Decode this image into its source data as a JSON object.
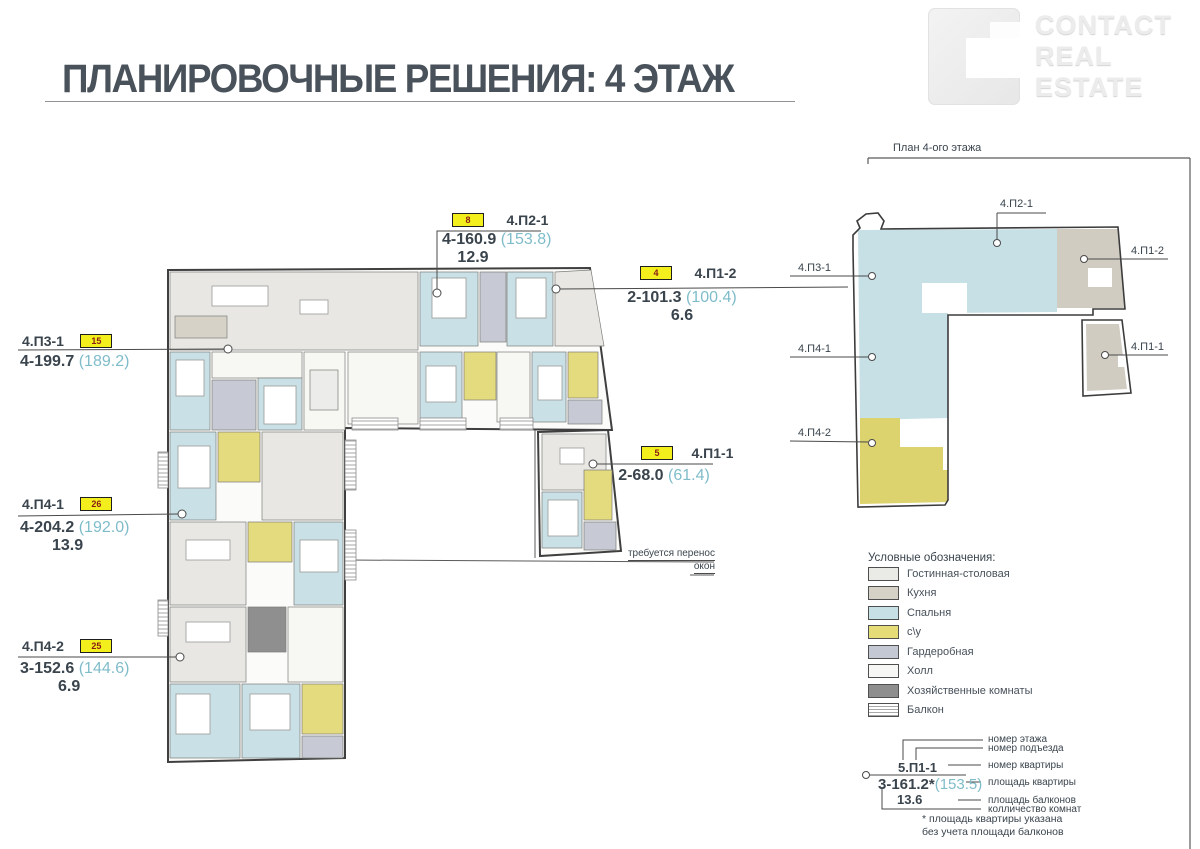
{
  "header": {
    "title": "ПЛАНИРОВОЧНЫЕ РЕШЕНИЯ: 4 ЭТАЖ"
  },
  "logo": {
    "line1": "CONTACT",
    "line2": "REAL",
    "line3": "ESTATE"
  },
  "key_plan": {
    "title": "План 4-ого этажа",
    "labels": [
      "4.П2-1",
      "4.П1-2",
      "4.П3-1",
      "4.П4-1",
      "4.П1-1",
      "4.П4-2"
    ]
  },
  "apartments": [
    {
      "id": "4.П2-1",
      "flat_number": "8",
      "rooms_area": "4-160.9",
      "net_area": "(153.8)",
      "balcony_area": "12.9"
    },
    {
      "id": "4.П1-2",
      "flat_number": "4",
      "rooms_area": "2-101.3",
      "net_area": "(100.4)",
      "balcony_area": "6.6"
    },
    {
      "id": "4.П3-1",
      "flat_number": "15",
      "rooms_area": "4-199.7",
      "net_area": "(189.2)",
      "balcony_area": ""
    },
    {
      "id": "4.П4-1",
      "flat_number": "26",
      "rooms_area": "4-204.2",
      "net_area": "(192.0)",
      "balcony_area": "13.9"
    },
    {
      "id": "4.П4-2",
      "flat_number": "25",
      "rooms_area": "3-152.6",
      "net_area": "(144.6)",
      "balcony_area": "6.9"
    },
    {
      "id": "4.П1-1",
      "flat_number": "5",
      "rooms_area": "2-68.0",
      "net_area": "(61.4)",
      "balcony_area": ""
    }
  ],
  "note": {
    "line1": "требуется перенос",
    "line2": "окон"
  },
  "legend": {
    "title": "Условные обозначения:",
    "items": [
      {
        "label": "Гостинная-столовая",
        "color": "#eaeae7"
      },
      {
        "label": "Кухня",
        "color": "#d5d1c7"
      },
      {
        "label": "Спальня",
        "color": "#c7e0e5"
      },
      {
        "label": "с\\у",
        "color": "#e5dc78"
      },
      {
        "label": "Гардеробная",
        "color": "#c4c8d3"
      },
      {
        "label": "Холл",
        "color": "#f7f7f6"
      },
      {
        "label": "Хозяйственные комнаты",
        "color": "#8e8e8e"
      },
      {
        "label": "Балкон",
        "color": "striped"
      }
    ]
  },
  "annotation": {
    "sample_id": "5.П1-1",
    "sample_rooms_area": "3-161.2*",
    "sample_net_area": "(153.5)",
    "sample_balcony": "13.6",
    "labels": [
      "номер этажа",
      "номер подъезда",
      "номер квартиры",
      "площадь квартиры",
      "площадь балконов",
      "колличество комнат"
    ],
    "footnote_line1": "* площадь квартиры указана",
    "footnote_line2": "без учета площади балконов"
  },
  "colors": {
    "accent_teal": "#7fbcca",
    "text_dark": "#3d4850",
    "badge_bg": "#f2ef1c",
    "badge_text": "#8a1d15",
    "bedroom": "#c9e1e6",
    "bathroom": "#e4da7e",
    "living": "#e8e7e3",
    "kitchen": "#d6d2c8",
    "wardrobe": "#c7cad4",
    "utility": "#8f8f8f",
    "hall": "#f7f7f4"
  }
}
